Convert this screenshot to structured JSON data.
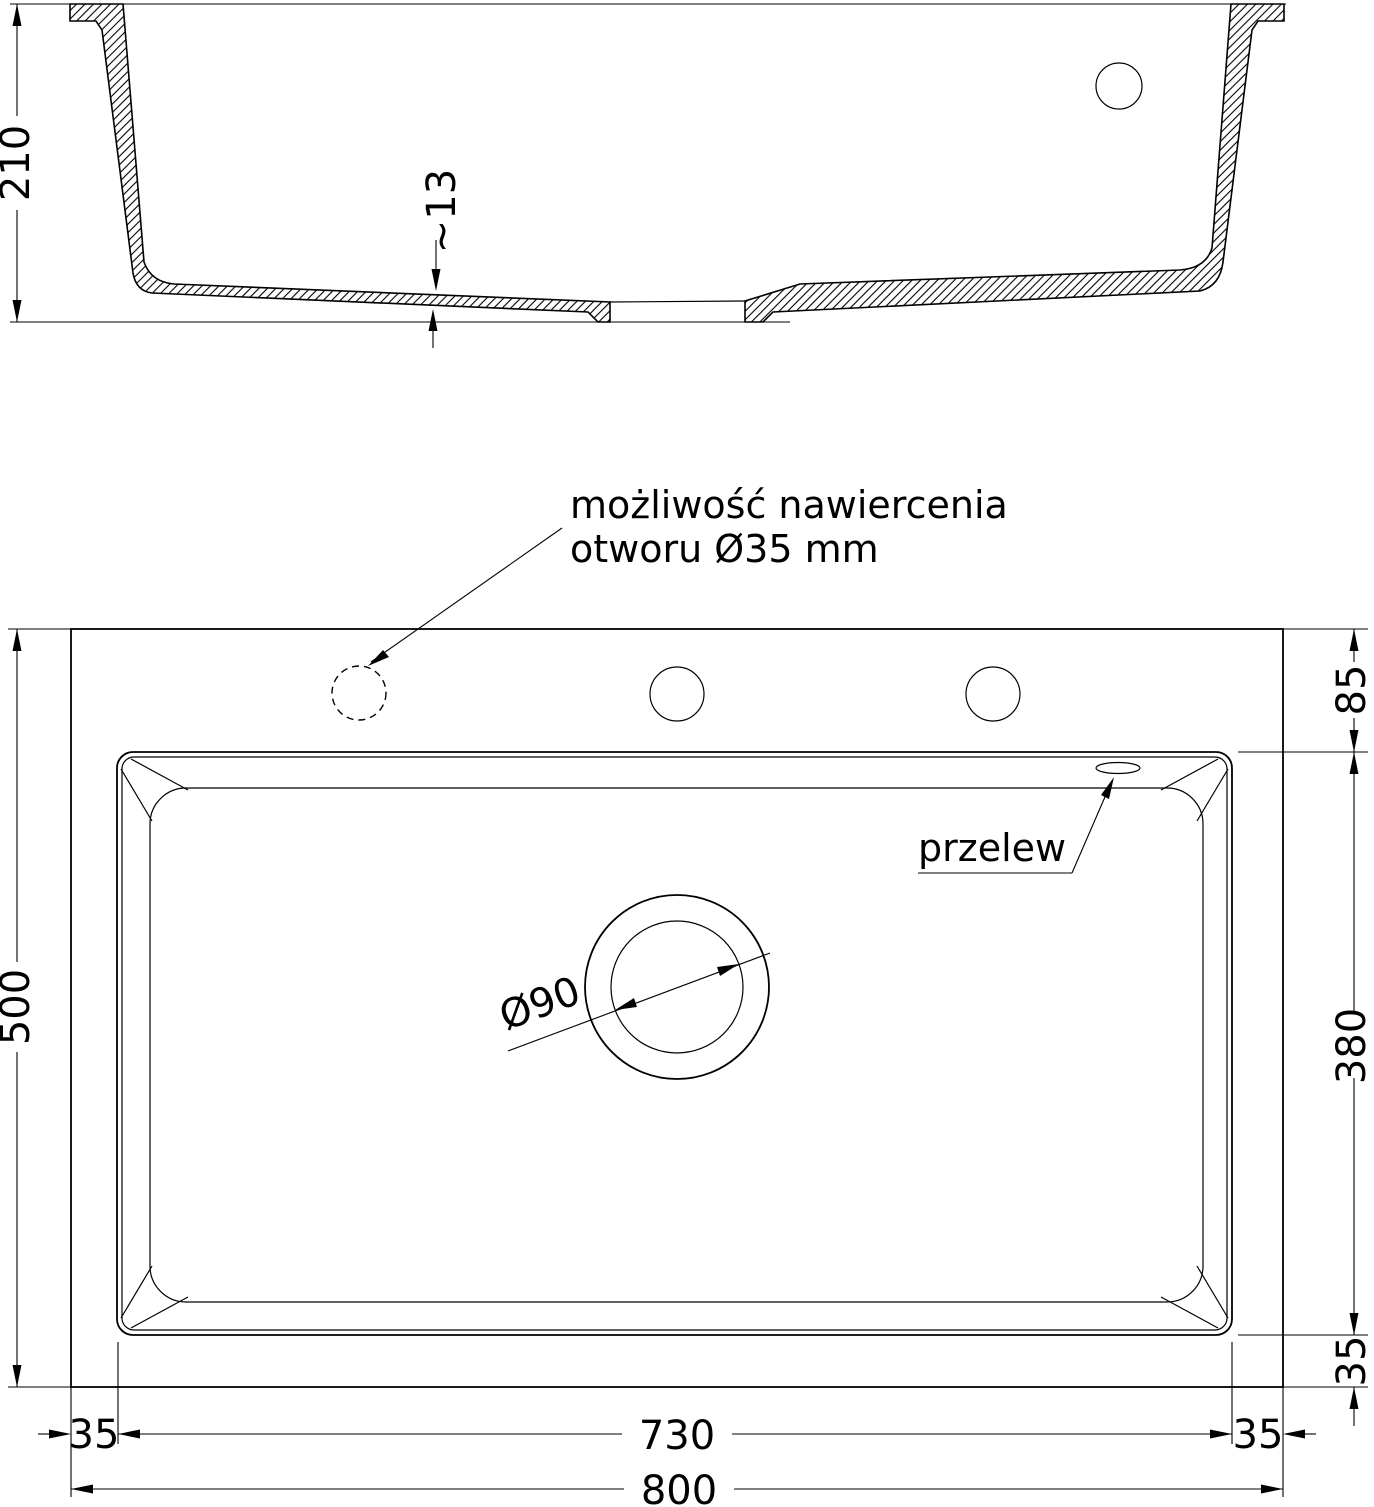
{
  "drawing": {
    "section": {
      "height_dim": "210",
      "bottom_thickness_dim": "~13"
    },
    "plan": {
      "overall_width_dim": "800",
      "overall_depth_dim": "500",
      "bowl_width_dim": "730",
      "bowl_depth_dim": "380",
      "top_offset_dim": "85",
      "left_offset_dim": "35",
      "right_offset_dim": "35",
      "bottom_offset_dim": "35",
      "drain_diameter_dim": "Ø90",
      "overflow_label": "przelew",
      "drill_note_line1": "możliwość nawiercenia",
      "drill_note_line2": "otworu Ø35 mm"
    },
    "colors": {
      "line": "#000000",
      "background": "#ffffff"
    }
  }
}
